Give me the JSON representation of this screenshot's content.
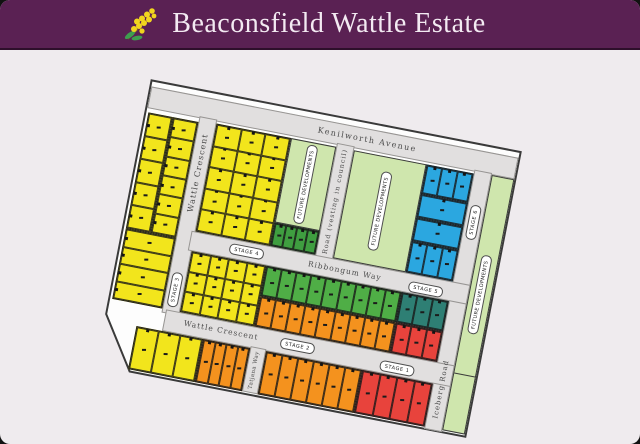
{
  "header": {
    "title": "Beaconsfield Wattle Estate"
  },
  "colors": {
    "header_bg": "#5a2153",
    "header_text": "#f3eaf2",
    "page_bg": "#efebee",
    "map_fill": "#fdfdfd",
    "boundary": "#3a3a3a",
    "road": "#e1dfdf",
    "road_edge": "#979593",
    "yellow": "#f2e51c",
    "green": "#4fae46",
    "dkgreen": "#3f9e40",
    "orange": "#f4921e",
    "red": "#e8433c",
    "blue": "#2ba7e0",
    "teal": "#2e7f74",
    "lightgreen": "#cfe6ad",
    "lot_line": "#1e1e1e",
    "label": "#4a4a4a",
    "logo_yellow": "#f0d51e",
    "logo_green": "#3e9e4f"
  },
  "map": {
    "roads": {
      "kenilworth": "Kenilworth Avenue",
      "wattle_vertical": "Wattle Crescent",
      "wattle_bottom": "Wattle Crescent",
      "ribbongum": "Ribbongum Way",
      "vesting": "Road (vesting in council)",
      "iceberg": "Iceberg Road",
      "tatjana": "Tatjana Way"
    },
    "stages": {
      "s1": "STAGE 1",
      "s2": "STAGE 2",
      "s3": "STAGE 3",
      "s4": "STAGE 4",
      "s5": "STAGE 5",
      "s6": "STAGE 6"
    },
    "future_developments": "FUTURE DEVELOPMENTS"
  }
}
